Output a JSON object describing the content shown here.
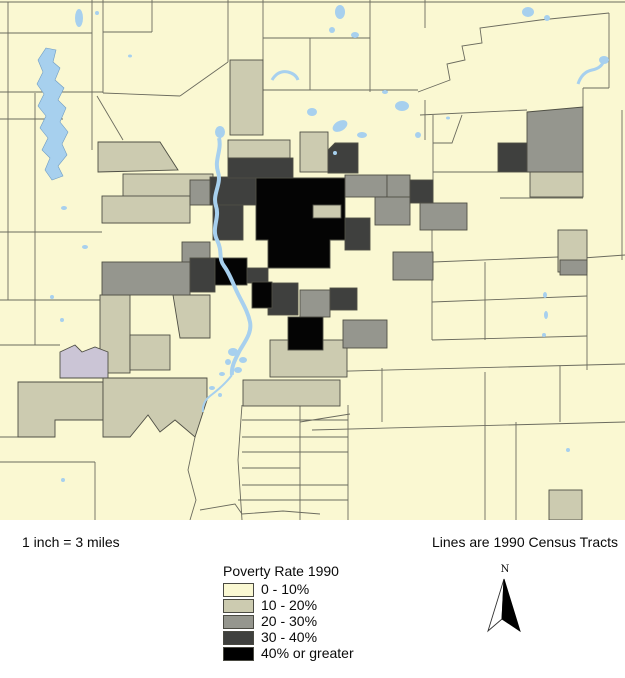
{
  "map": {
    "scale_label": "1 inch = 3 miles",
    "note_label": "Lines are 1990 Census Tracts"
  },
  "legend": {
    "title": "Poverty Rate 1990",
    "items": [
      {
        "label": "0 - 10%",
        "color": "#FAF8D2"
      },
      {
        "label": "10 - 20%",
        "color": "#CCCBB0"
      },
      {
        "label": "20 - 30%",
        "color": "#95968E"
      },
      {
        "label": "30 - 40%",
        "color": "#3F403E"
      },
      {
        "label": "40% or greater",
        "color": "#000000"
      }
    ]
  },
  "north_arrow": {
    "label": "N"
  },
  "map_colors": {
    "water": "#A7D0EE",
    "tract_line": "#6B6B5E",
    "no_data_tract": "#CBC5D6",
    "background": "#FAF8D2"
  }
}
